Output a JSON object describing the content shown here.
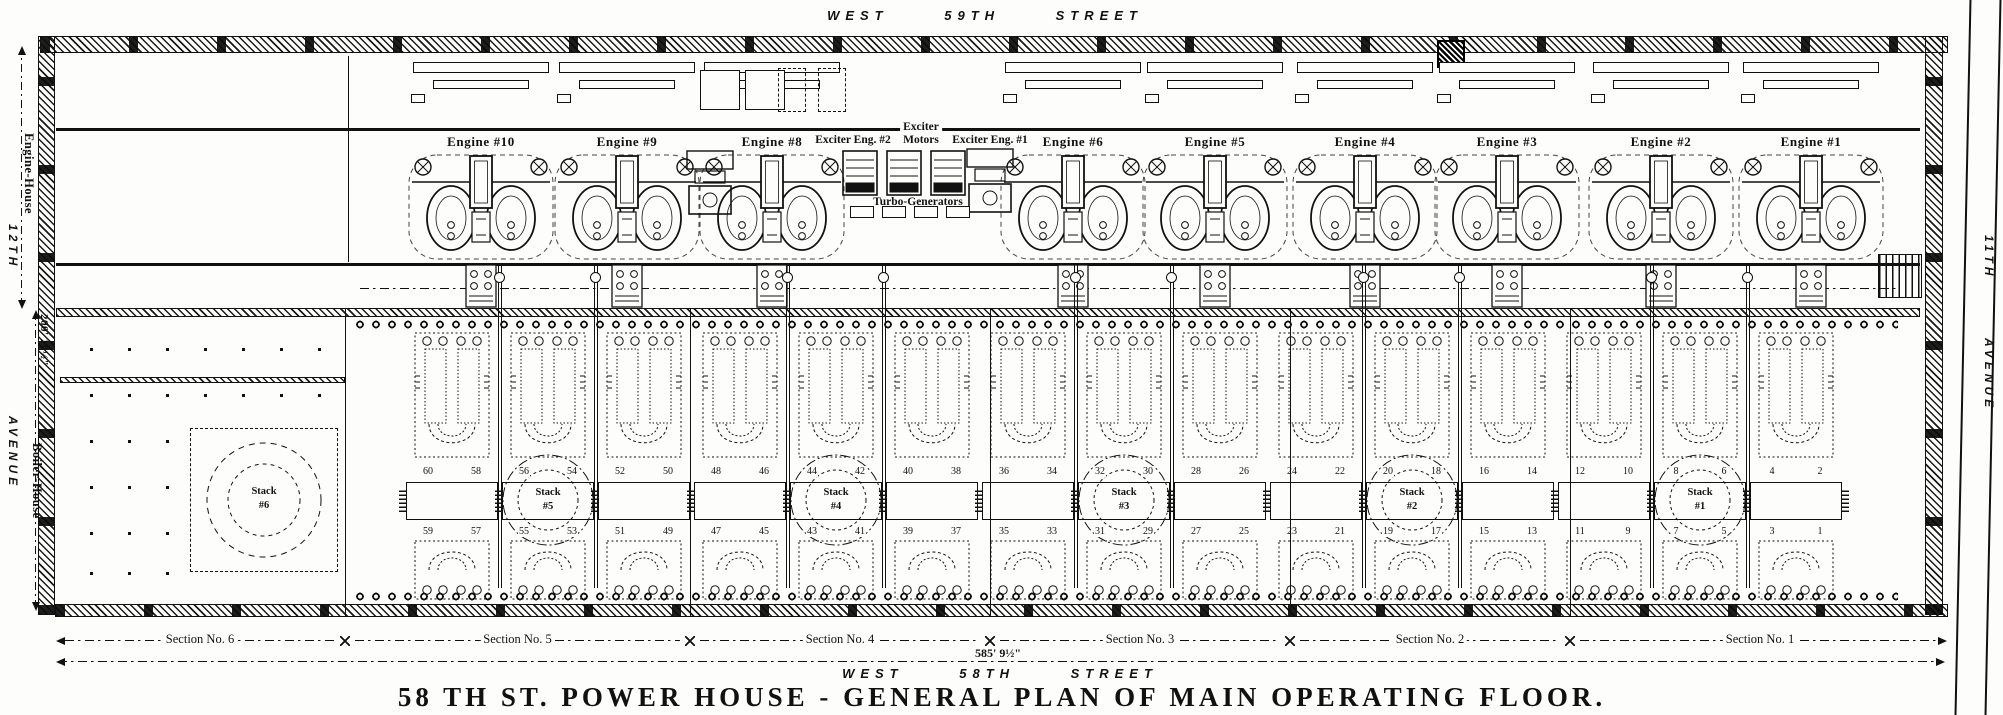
{
  "streets": {
    "top": "WEST 59TH STREET",
    "bottom": "WEST 58TH STREET"
  },
  "title": "58 TH ST. POWER HOUSE - GENERAL PLAN OF MAIN OPERATING FLOOR.",
  "left_side": {
    "avenue_line1": "12TH",
    "avenue_line2": "AVENUE",
    "engine_house": "Engine-House",
    "boiler_house": "Boiler-House",
    "engine_house_depth": "200' 10½\""
  },
  "right_side": {
    "avenue_line1": "11TH",
    "avenue_line2": "AVENUE"
  },
  "engine_labels": [
    "Engine #10",
    "Engine #9",
    "Engine #8",
    "Engine #6",
    "Engine #5",
    "Engine #4",
    "Engine #3",
    "Engine #2",
    "Engine #1"
  ],
  "exciter": {
    "eng2": "Exciter Eng. #2",
    "motors_line1": "Exciter",
    "motors_line2": "Motors",
    "eng1": "Exciter Eng. #1",
    "turbo": "Turbo-Generators"
  },
  "stacks": [
    {
      "line1": "Stack",
      "line2": "#6"
    },
    {
      "line1": "Stack",
      "line2": "#5"
    },
    {
      "line1": "Stack",
      "line2": "#4"
    },
    {
      "line1": "Stack",
      "line2": "#3"
    },
    {
      "line1": "Stack",
      "line2": "#2"
    },
    {
      "line1": "Stack",
      "line2": "#1"
    }
  ],
  "boiler_numbers_top": [
    "60",
    "58",
    "56",
    "54",
    "52",
    "50",
    "48",
    "46",
    "44",
    "42",
    "40",
    "38",
    "36",
    "34",
    "32",
    "30",
    "28",
    "26",
    "24",
    "22",
    "20",
    "18",
    "16",
    "14",
    "12",
    "10",
    "8",
    "6",
    "4",
    "2"
  ],
  "boiler_numbers_bottom": [
    "59",
    "57",
    "55",
    "53",
    "51",
    "49",
    "47",
    "45",
    "43",
    "41",
    "39",
    "37",
    "35",
    "33",
    "31",
    "29",
    "27",
    "25",
    "23",
    "21",
    "19",
    "17",
    "15",
    "13",
    "11",
    "9",
    "7",
    "5",
    "3",
    "1"
  ],
  "sections": [
    "Section No. 6",
    "Section No. 5",
    "Section No. 4",
    "Section No. 3",
    "Section No. 2",
    "Section No. 1"
  ],
  "total_dimension": "585' 9½\""
}
